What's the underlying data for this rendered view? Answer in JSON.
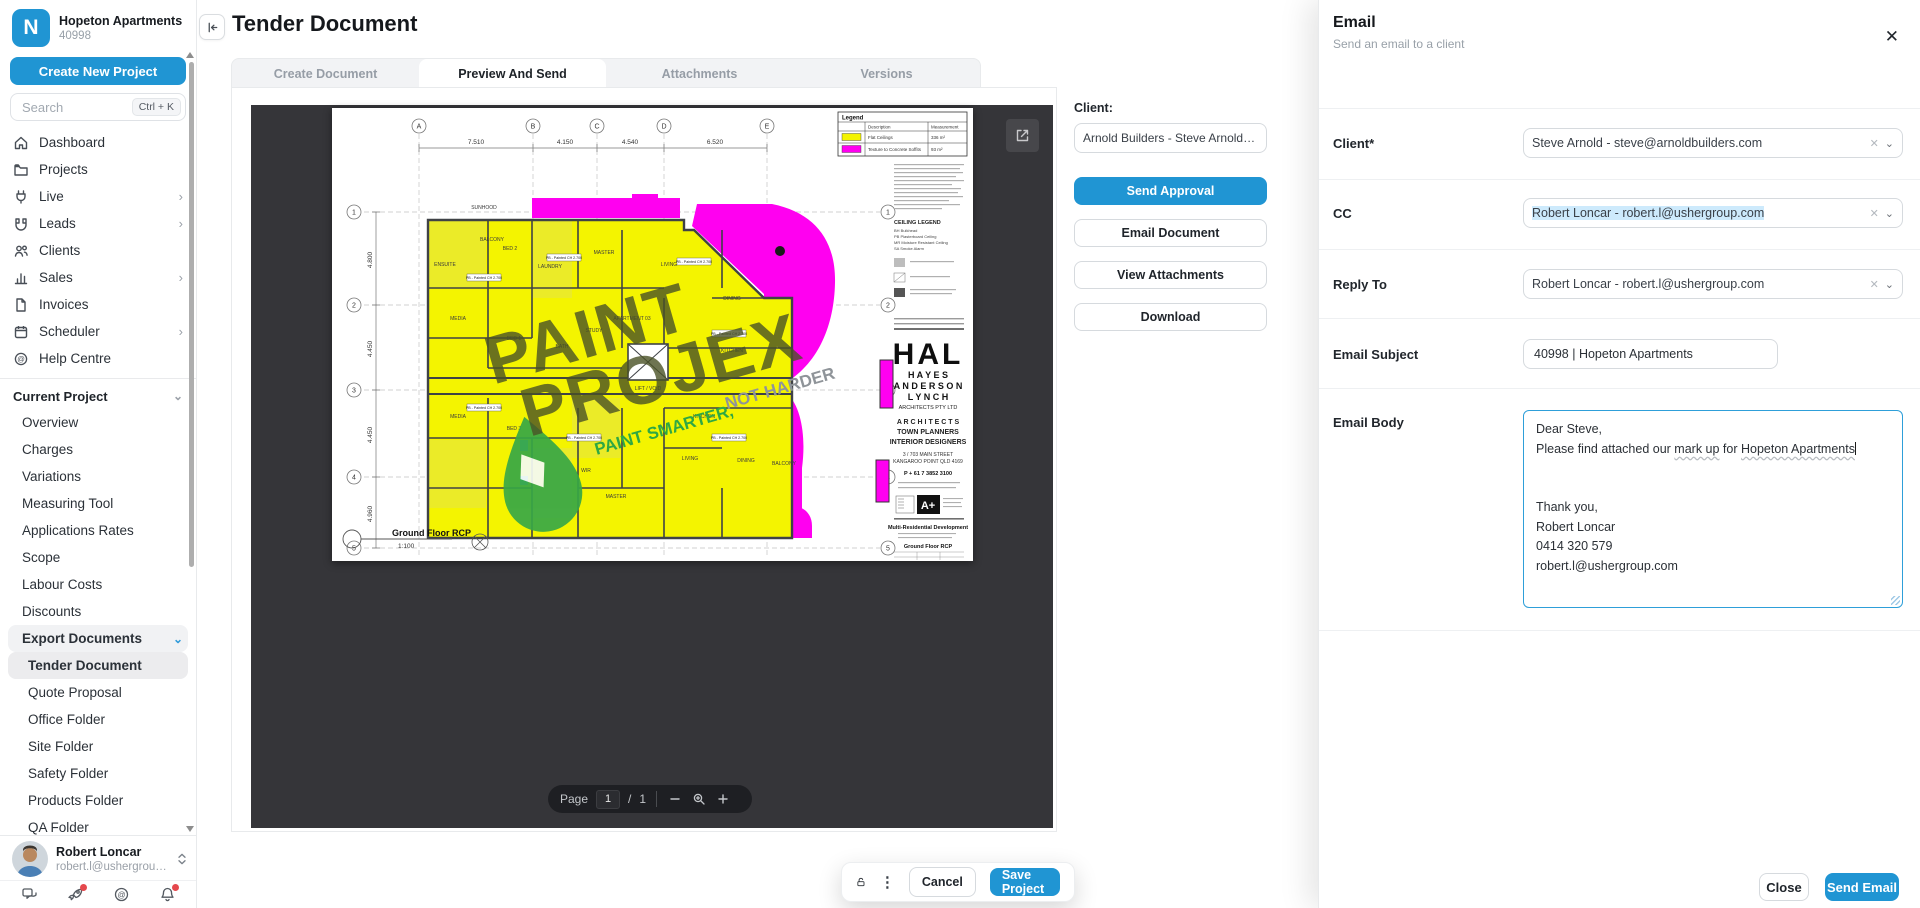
{
  "colors": {
    "accent": "#2095d3",
    "plan_yellow": "#f4f400",
    "plan_magenta": "#ff00f0",
    "watermark_green": "#37a746",
    "notification_red": "#e5484d"
  },
  "sidebar": {
    "project_name": "Hopeton Apartments",
    "project_code": "40998",
    "create_project_label": "Create New Project",
    "search_placeholder": "Search",
    "search_shortcut": "Ctrl + K",
    "nav": [
      {
        "label": "Dashboard"
      },
      {
        "label": "Projects"
      },
      {
        "label": "Live"
      },
      {
        "label": "Leads"
      },
      {
        "label": "Clients"
      },
      {
        "label": "Sales"
      },
      {
        "label": "Invoices"
      },
      {
        "label": "Scheduler"
      },
      {
        "label": "Help Centre"
      }
    ],
    "current_project_label": "Current Project",
    "project_nav": [
      "Overview",
      "Charges",
      "Variations",
      "Measuring Tool",
      "Applications Rates",
      "Scope",
      "Labour Costs",
      "Discounts"
    ],
    "export_documents_label": "Export Documents",
    "export_nav": [
      "Tender Document",
      "Quote Proposal",
      "Office Folder",
      "Site Folder",
      "Safety Folder",
      "Products Folder",
      "QA Folder"
    ],
    "user": {
      "name": "Robert Loncar",
      "email": "robert.l@ushergroup...."
    }
  },
  "header": {
    "title": "Tender Document"
  },
  "tabs": {
    "create": "Create Document",
    "preview": "Preview And Send",
    "attachments": "Attachments",
    "versions": "Versions"
  },
  "client_panel": {
    "label": "Client:",
    "selected": "Arnold Builders - Steve Arnold - steve@arnold",
    "send_approval": "Send Approval",
    "email_document": "Email Document",
    "view_attachments": "View Attachments",
    "download": "Download"
  },
  "pager": {
    "label": "Page",
    "current": "1",
    "separator": "/",
    "total": "1"
  },
  "bottom_bar": {
    "cancel": "Cancel",
    "save": "Save Project"
  },
  "email_panel": {
    "title": "Email",
    "subtitle": "Send an email to a client",
    "client_label": "Client*",
    "client_value": "Steve Arnold - steve@arnoldbuilders.com",
    "cc_label": "CC",
    "cc_value": "Robert Loncar - robert.l@ushergroup.com",
    "reply_to_label": "Reply To",
    "reply_to_value": "Robert Loncar - robert.l@ushergroup.com",
    "subject_label": "Email Subject",
    "subject_value": "40998 | Hopeton Apartments",
    "body_label": "Email Body",
    "body": {
      "greeting": "Dear Steve,",
      "line2_a": "Please find attached our ",
      "line2_markup": "mark up",
      "line2_b": " for ",
      "line2_project": "Hopeton Apartments",
      "thanks": "Thank you,",
      "sig_name": "Robert Loncar",
      "sig_phone": "0414 320 579",
      "sig_email": "robert.l@ushergroup.com"
    },
    "close": "Close",
    "send": "Send Email"
  },
  "plan": {
    "legend": {
      "title": "Legend",
      "col_description": "Description",
      "col_measurement": "Measurement",
      "row1_label": "Flat Ceilings",
      "row1_value": "336 m²",
      "row2_label": "Texture to Concrete Soffits",
      "row2_value": "93 m²"
    },
    "watermark": {
      "line1": "PAINT",
      "line2": "PROJEX",
      "tag_green": "PAINT SMARTER,",
      "tag_gray": "NOT HARDER"
    },
    "grid": {
      "cols": [
        "A",
        "B",
        "C",
        "D",
        "E"
      ],
      "rows": [
        "1",
        "2",
        "3",
        "4",
        "5"
      ],
      "top_dims": [
        "7.510",
        "4.150",
        "4.540",
        "6.520"
      ],
      "left_dims": [
        "4.800",
        "4.450",
        "4.450",
        "4.960"
      ]
    },
    "annotation": "PB - Painted CH 2.700",
    "rooms": [
      "SUNHOOD",
      "BALCONY",
      "BED 2",
      "ENSUITE",
      "LAUNDRY",
      "MASTER",
      "LIVING",
      "DINING",
      "MEDIA",
      "BED 1",
      "BATH",
      "STUDY",
      "APARTMENT 03",
      "LIFT / VOID",
      "KITCHEN",
      "MEDIA",
      "BED 3",
      "WIR",
      "MASTER",
      "LIVING",
      "DINING",
      "KITCHEN",
      "BALCONY"
    ],
    "ceiling_legend": {
      "title": "CEILING LEGEND",
      "items": [
        "BH  Bulkhead",
        "PB  Plasterboard Ceiling",
        "MR  Moisture Resistant Ceiling",
        "SA  Smoke Alarm"
      ]
    },
    "title_block": {
      "logo": "HAL",
      "firm1": "H A Y E S",
      "firm2": "A N D E R S O N",
      "firm3": "L Y N C H",
      "firm_sub": "ARCHITECTS PTY LTD",
      "svc1": "A R C H I T E C T S",
      "svc2": "TOWN PLANNERS",
      "svc3": "INTERIOR DESIGNERS",
      "addr1": "3 / 703 MAIN STREET",
      "addr2": "KANGAROO POINT QLD 4169",
      "phone": "P + 61 7 3852 3100",
      "project": "Multi-Residential Development",
      "drawing": "Ground Floor RCP"
    },
    "footer": {
      "label": "Ground Floor RCP",
      "scale": "1:100"
    }
  }
}
